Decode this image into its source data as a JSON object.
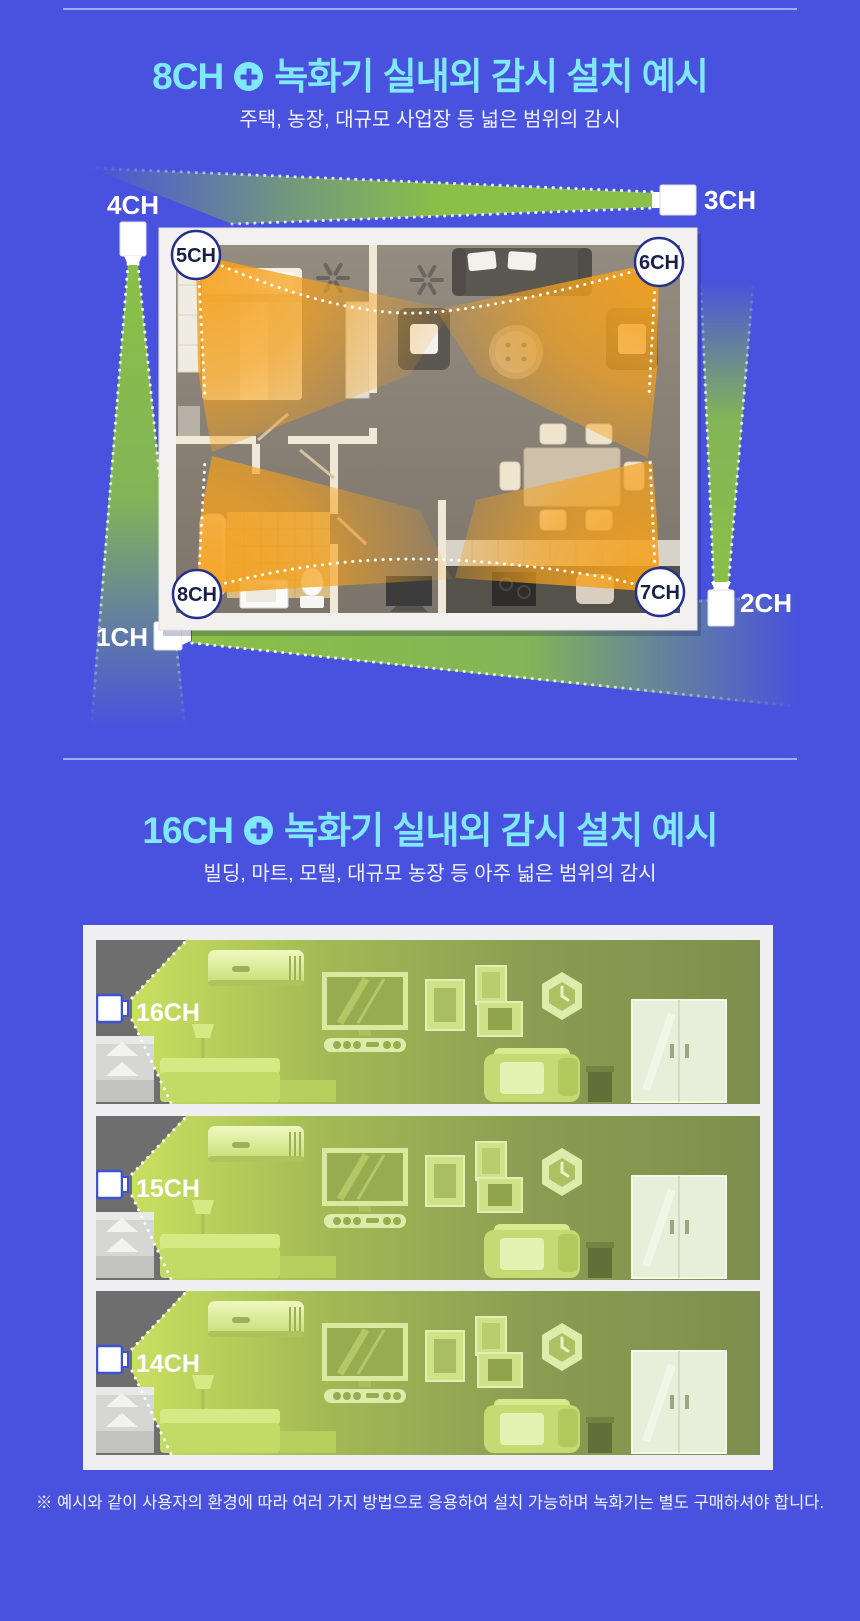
{
  "theme": {
    "background": "#4852de",
    "title_color": "#7fe8fa",
    "beam_green": "#8dc63f",
    "fov_orange": "#f5a11c",
    "room_lit_green": "#c8e060",
    "camera_border_blue": "#3d52d5"
  },
  "section_8ch": {
    "title_channel": "8CH",
    "title_text": "녹화기 실내외 감시 설치 예시",
    "subtitle": "주택, 농장, 대규모 사업장 등 넓은 범위의 감시",
    "outdoor_cameras": [
      {
        "label": "1CH"
      },
      {
        "label": "2CH"
      },
      {
        "label": "3CH"
      },
      {
        "label": "4CH"
      }
    ],
    "indoor_cameras": [
      {
        "label": "5CH"
      },
      {
        "label": "6CH"
      },
      {
        "label": "7CH"
      },
      {
        "label": "8CH"
      }
    ]
  },
  "section_16ch": {
    "title_channel": "16CH",
    "title_text": "녹화기 실내외 감시 설치 예시",
    "subtitle": "빌딩, 마트, 모텔, 대규모 농장 등 아주 넓은 범위의 감시",
    "rooms": [
      {
        "label": "16CH"
      },
      {
        "label": "15CH"
      },
      {
        "label": "14CH"
      }
    ]
  },
  "footer": {
    "note": "※ 예시와 같이 사용자의 환경에 따라 여러 가지 방법으로 응용하여 설치 가능하며 녹화기는 별도 구매하셔야 합니다."
  }
}
